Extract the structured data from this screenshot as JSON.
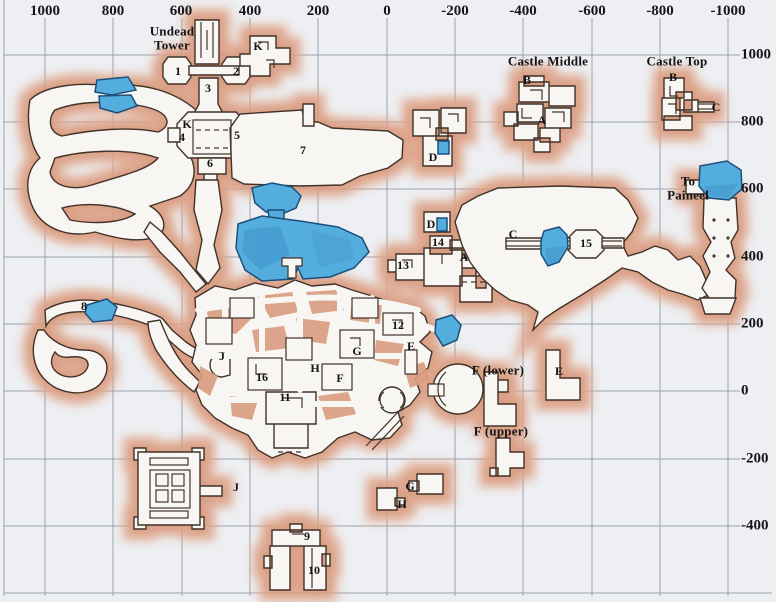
{
  "map": {
    "name": "hand-drawn dungeon zone map with coordinate grid",
    "axis_top": [
      {
        "label": "1000",
        "x": 45
      },
      {
        "label": "800",
        "x": 113
      },
      {
        "label": "600",
        "x": 181
      },
      {
        "label": "400",
        "x": 250
      },
      {
        "label": "200",
        "x": 318
      },
      {
        "label": "0",
        "x": 387
      },
      {
        "label": "-200",
        "x": 455
      },
      {
        "label": "-400",
        "x": 523
      },
      {
        "label": "-600",
        "x": 592
      },
      {
        "label": "-800",
        "x": 660
      },
      {
        "label": "-1000",
        "x": 728
      }
    ],
    "axis_right": [
      {
        "label": "1000",
        "y": 55
      },
      {
        "label": "800",
        "y": 122
      },
      {
        "label": "600",
        "y": 189
      },
      {
        "label": "400",
        "y": 257
      },
      {
        "label": "200",
        "y": 324
      },
      {
        "label": "0",
        "y": 391
      },
      {
        "label": "-200",
        "y": 459
      },
      {
        "label": "-400",
        "y": 526
      }
    ],
    "labels": [
      {
        "text": "Undead",
        "x": 172,
        "y": 31,
        "cls": "zone"
      },
      {
        "text": "Tower",
        "x": 172,
        "y": 45,
        "cls": "zone"
      },
      {
        "text": "K",
        "x": 258,
        "y": 46,
        "cls": "point"
      },
      {
        "text": "1",
        "x": 178,
        "y": 71,
        "cls": "point"
      },
      {
        "text": "2",
        "x": 236,
        "y": 71,
        "cls": "point"
      },
      {
        "text": "3",
        "x": 208,
        "y": 88,
        "cls": "point"
      },
      {
        "text": "K",
        "x": 187,
        "y": 124,
        "cls": "point"
      },
      {
        "text": "4",
        "x": 182,
        "y": 137,
        "cls": "point"
      },
      {
        "text": "5",
        "x": 237,
        "y": 135,
        "cls": "point"
      },
      {
        "text": "6",
        "x": 210,
        "y": 163,
        "cls": "point"
      },
      {
        "text": "7",
        "x": 303,
        "y": 150,
        "cls": "point"
      },
      {
        "text": "Castle Middle",
        "x": 548,
        "y": 61,
        "cls": "zone"
      },
      {
        "text": "B",
        "x": 527,
        "y": 80,
        "cls": "point"
      },
      {
        "text": "A",
        "x": 542,
        "y": 120,
        "cls": "point"
      },
      {
        "text": "Castle Top",
        "x": 677,
        "y": 61,
        "cls": "zone"
      },
      {
        "text": "B",
        "x": 673,
        "y": 77,
        "cls": "point"
      },
      {
        "text": "C",
        "x": 716,
        "y": 107,
        "cls": "point"
      },
      {
        "text": "D",
        "x": 433,
        "y": 157,
        "cls": "point"
      },
      {
        "text": "To",
        "x": 688,
        "y": 181,
        "cls": "zone"
      },
      {
        "text": "Paineel",
        "x": 688,
        "y": 195,
        "cls": "zone"
      },
      {
        "text": "D",
        "x": 431,
        "y": 224,
        "cls": "point"
      },
      {
        "text": "14",
        "x": 438,
        "y": 242,
        "cls": "point"
      },
      {
        "text": "A",
        "x": 464,
        "y": 257,
        "cls": "point"
      },
      {
        "text": "13",
        "x": 403,
        "y": 265,
        "cls": "point"
      },
      {
        "text": "C",
        "x": 513,
        "y": 234,
        "cls": "point"
      },
      {
        "text": "15",
        "x": 586,
        "y": 243,
        "cls": "point"
      },
      {
        "text": "8",
        "x": 84,
        "y": 306,
        "cls": "point"
      },
      {
        "text": "12",
        "x": 398,
        "y": 325,
        "cls": "point"
      },
      {
        "text": "E",
        "x": 411,
        "y": 346,
        "cls": "point"
      },
      {
        "text": "G",
        "x": 357,
        "y": 351,
        "cls": "point"
      },
      {
        "text": "J",
        "x": 222,
        "y": 356,
        "cls": "point"
      },
      {
        "text": "H",
        "x": 315,
        "y": 368,
        "cls": "point"
      },
      {
        "text": "F",
        "x": 340,
        "y": 378,
        "cls": "point"
      },
      {
        "text": "16",
        "x": 262,
        "y": 377,
        "cls": "point"
      },
      {
        "text": "F (lower)",
        "x": 498,
        "y": 370,
        "cls": "zone"
      },
      {
        "text": "E",
        "x": 559,
        "y": 371,
        "cls": "point"
      },
      {
        "text": "11",
        "x": 285,
        "y": 397,
        "cls": "point"
      },
      {
        "text": "F (upper)",
        "x": 501,
        "y": 431,
        "cls": "zone"
      },
      {
        "text": "J",
        "x": 236,
        "y": 487,
        "cls": "point"
      },
      {
        "text": "G",
        "x": 410,
        "y": 486,
        "cls": "point"
      },
      {
        "text": "H",
        "x": 402,
        "y": 504,
        "cls": "point"
      },
      {
        "text": "9",
        "x": 307,
        "y": 536,
        "cls": "point"
      },
      {
        "text": "10",
        "x": 314,
        "y": 570,
        "cls": "point"
      }
    ],
    "colors": {
      "paper": "#edeff2",
      "grid": "#8f95a0",
      "halo": "#dfa58a",
      "cave_fill": "#f8f6f3",
      "outline": "#413228",
      "water": "#54aedd",
      "water_dark": "#3f95cc",
      "water_outline": "#1c4f7c",
      "island": "#d99e83",
      "label": "#141414"
    }
  }
}
